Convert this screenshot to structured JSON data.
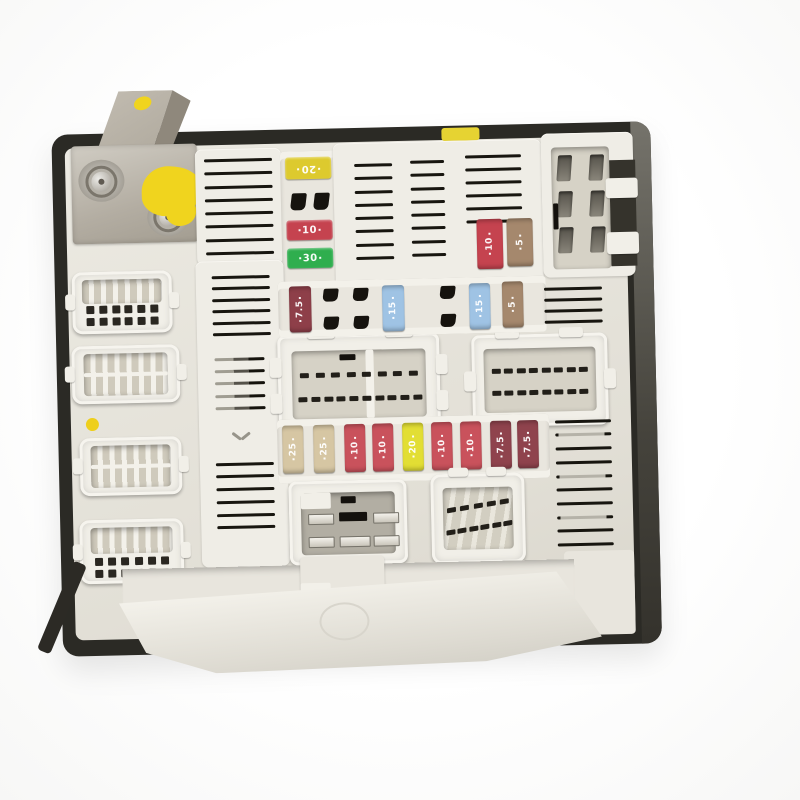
{
  "scene": {
    "type": "product photograph",
    "subject": "automotive engine-bay fuse box module with blade fuses and multi-pin connector sockets",
    "background_color": "#fcfcfc"
  },
  "palette": {
    "plastic_body": "#e9e6de",
    "housing": "#2b2a25",
    "metal_bracket": "#b3ada2",
    "paint_mark_yellow": "#f0d41e",
    "fuse_yellow": "#ddca2e",
    "fuse_red": "#c5434f",
    "fuse_green": "#2fae4e",
    "fuse_maroon": "#8e3f49",
    "fuse_blue": "#9fc3e4",
    "fuse_tan": "#a5886d",
    "fuse_natural": "#d6c6a3"
  },
  "fuses": {
    "column_top_left": [
      {
        "label": "20",
        "color": "#ddca2e"
      },
      {
        "label": "10",
        "color": "#c5434f"
      },
      {
        "label": "30",
        "color": "#2fae4e"
      }
    ],
    "pair_upper_right": [
      {
        "label": "10",
        "color": "#c5434f"
      },
      {
        "label": "5",
        "color": "#a5886d"
      }
    ],
    "row_middle": [
      {
        "label": "7.5",
        "color": "#8e3f49"
      },
      {
        "label": "15",
        "color": "#9fc3e4"
      },
      {
        "label": "15",
        "color": "#9fc3e4"
      },
      {
        "label": "5",
        "color": "#a5886d"
      }
    ],
    "row_bottom": [
      {
        "label": "25",
        "color": "#d6c6a3"
      },
      {
        "label": "25",
        "color": "#d6c6a3"
      },
      {
        "label": "10",
        "color": "#c9525c"
      },
      {
        "label": "10",
        "color": "#c9525c"
      },
      {
        "label": "20",
        "color": "#e2de34"
      },
      {
        "label": "10",
        "color": "#c9525c"
      },
      {
        "label": "10",
        "color": "#c9525c"
      },
      {
        "label": "7.5",
        "color": "#8f434d"
      },
      {
        "label": "7.5",
        "color": "#8f434d"
      }
    ]
  }
}
